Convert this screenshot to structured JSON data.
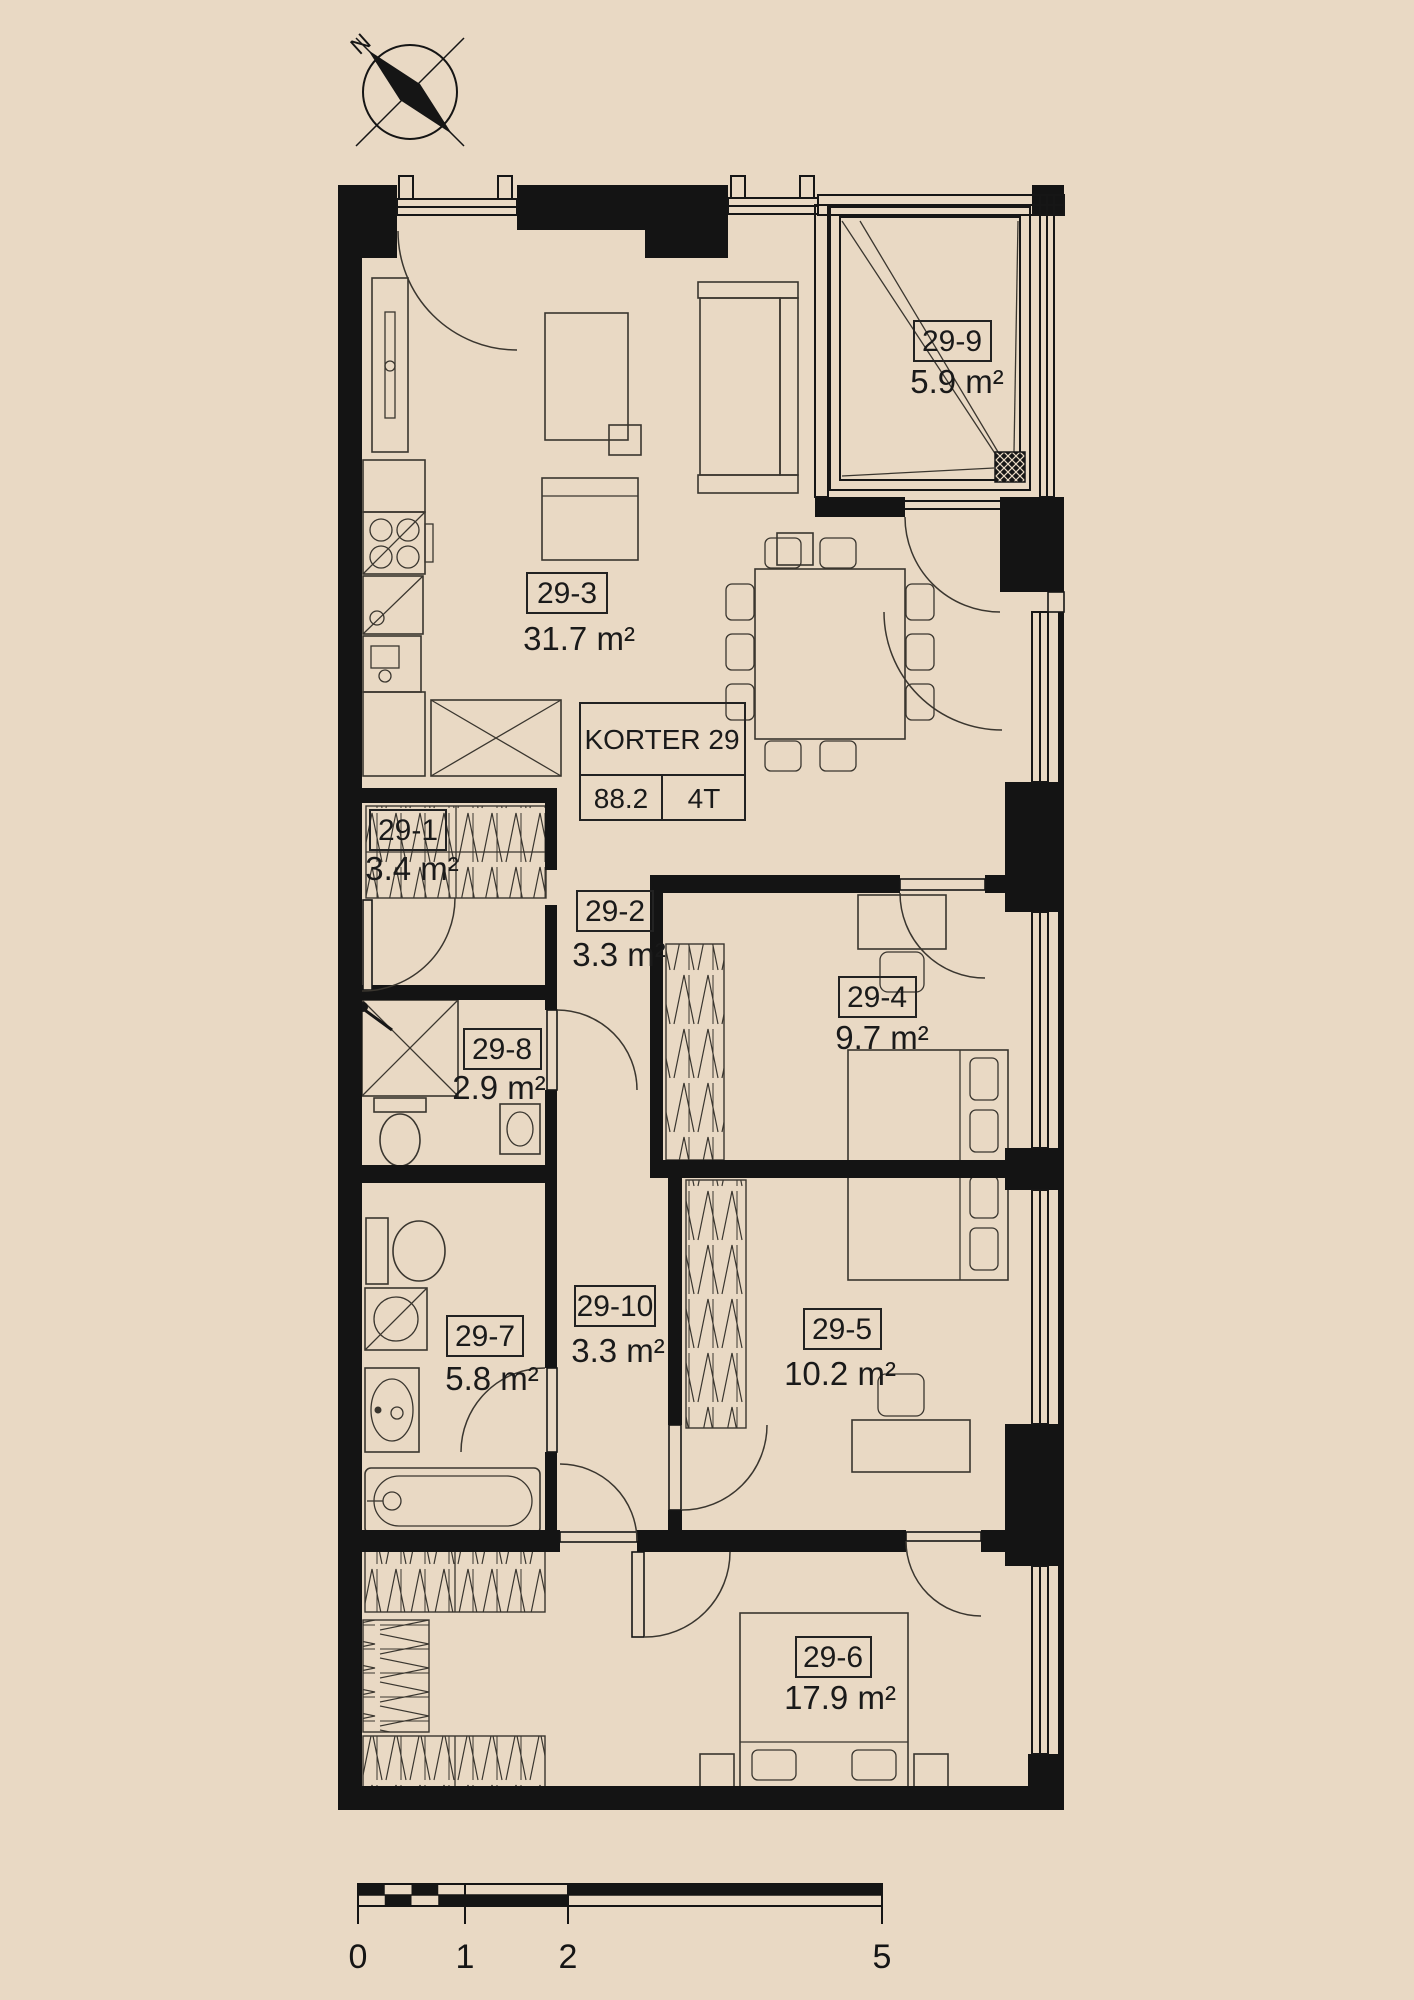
{
  "plan": {
    "info_table": {
      "title": "KORTER 29",
      "area_value": "88.2",
      "rooms_value": "4T"
    },
    "compass": {
      "north_label": "N"
    },
    "rooms": {
      "r1": {
        "id": "29-1",
        "area": "3.4 m²"
      },
      "r2": {
        "id": "29-2",
        "area": "3.3 m²"
      },
      "r3": {
        "id": "29-3",
        "area": "31.7 m²"
      },
      "r4": {
        "id": "29-4",
        "area": "9.7 m²"
      },
      "r5": {
        "id": "29-5",
        "area": "10.2 m²"
      },
      "r6": {
        "id": "29-6",
        "area": "17.9 m²"
      },
      "r7": {
        "id": "29-7",
        "area": "5.8 m²"
      },
      "r8": {
        "id": "29-8",
        "area": "2.9 m²"
      },
      "r9": {
        "id": "29-9",
        "area": "5.9 m²"
      },
      "r10": {
        "id": "29-10",
        "area": "3.3 m²"
      }
    },
    "scale_bar": {
      "tick0": "0",
      "tick1": "1",
      "tick2": "2",
      "tick3": "5"
    },
    "colors": {
      "background": "#e9d9c4",
      "wall": "#141414",
      "line": "#3a362f",
      "text": "#1a1a1a"
    }
  }
}
